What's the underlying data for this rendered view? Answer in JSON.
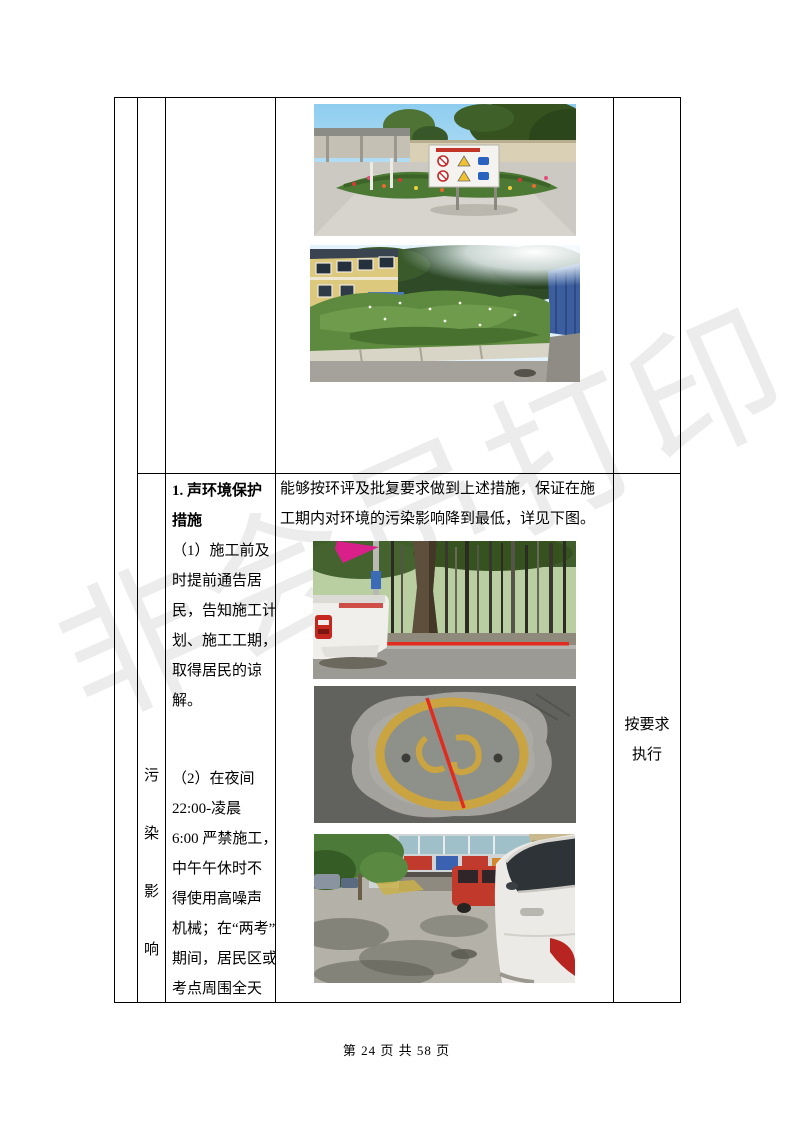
{
  "document": {
    "watermark_text": "非会员打印",
    "footer_page_label": "第 24 页 共 58 页"
  },
  "colors": {
    "table_border": "#000000",
    "watermark": "#ececec",
    "annotation_line_red": "#e32a1e"
  },
  "table": {
    "row_label_column": {
      "vertical_text": [
        "污",
        "染",
        "影",
        "响"
      ]
    },
    "measures_cell": {
      "heading_lines": [
        "1. 声环境保护",
        "措施"
      ],
      "item1_lines": [
        "（1）施工前及",
        "时提前通告居",
        "民，告知施工计",
        "划、施工工期，",
        "取得居民的谅",
        "解。"
      ],
      "item2_lines": [
        "（2）在夜间",
        "22:00-凌晨",
        "6:00 严禁施工，",
        "中午午休时不",
        "得使用高噪声",
        "机械；在“两考”",
        "期间，居民区或",
        "考点周围全天"
      ]
    },
    "implementation_cell": {
      "paragraph_lines": [
        "能够按环评及批复要求做到上述措施，保证在施",
        "工期内对环境的污染影响降到最低，详见下图。"
      ]
    },
    "status_cell": {
      "lines": [
        "按要求",
        "执行"
      ]
    },
    "photos": {
      "row1": [
        {
          "name": "photo-garden-safety-sign",
          "alt": "厂区花坛、花草与安全警示牌"
        },
        {
          "name": "photo-building-meadow",
          "alt": "黄色楼房旁的绿化草甸与阳光"
        }
      ],
      "row2": [
        {
          "name": "photo-forest-truck-redline",
          "alt": "林带道路与白色皮卡车（红线标注）"
        },
        {
          "name": "photo-manhole-redline",
          "alt": "路面黄色井盖标记（红线标注）"
        },
        {
          "name": "photo-street-white-car",
          "alt": "沿街商铺人行道与白色轿车"
        }
      ]
    }
  }
}
